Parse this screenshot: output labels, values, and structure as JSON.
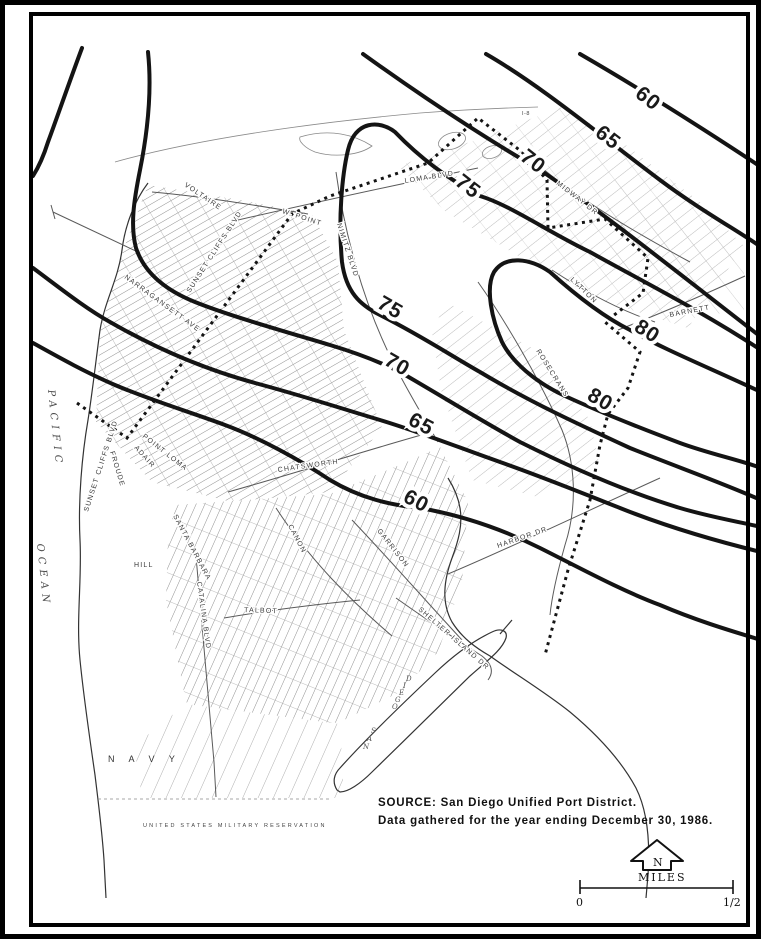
{
  "page": {
    "background": "#ffffff",
    "ink": "#141414",
    "street_gray": "#8f8f8f"
  },
  "source": {
    "line1": "SOURCE:  San Diego Unified Port District.",
    "line2": "Data gathered for the year ending December 30, 1986."
  },
  "scale": {
    "left": "0",
    "right": "1/2",
    "units": "MILES",
    "north_letter": "N"
  },
  "ocean": {
    "line1": "PACIFIC",
    "line2": "OCEAN"
  },
  "bay": {
    "word1_letters": [
      "S",
      "A",
      "N"
    ],
    "word2_letters": [
      "D",
      "I",
      "E",
      "G",
      "O"
    ]
  },
  "areas": {
    "navy": "N A V Y",
    "military": "UNITED STATES MILITARY RESERVATION"
  },
  "contour_labels": [
    {
      "text": "60"
    },
    {
      "text": "65"
    },
    {
      "text": "70"
    },
    {
      "text": "75"
    },
    {
      "text": "80"
    },
    {
      "text": "80"
    },
    {
      "text": "75"
    },
    {
      "text": "70"
    },
    {
      "text": "65"
    },
    {
      "text": "60"
    }
  ],
  "street_labels": [
    {
      "text": "VOLTAIRE"
    },
    {
      "text": "SUNSET CLIFFS BLVD"
    },
    {
      "text": "NARRAGANSETT AVE"
    },
    {
      "text": "W. POINT"
    },
    {
      "text": "LOMA BLVD"
    },
    {
      "text": "NIMITZ BLVD"
    },
    {
      "text": "MIDWAY DR"
    },
    {
      "text": "LYTTON"
    },
    {
      "text": "BARNETT"
    },
    {
      "text": "ROSECRANS"
    },
    {
      "text": "SUNSET CLIFFS BLVD"
    },
    {
      "text": "FROUDE"
    },
    {
      "text": "POINT LOMA"
    },
    {
      "text": "ADAIR"
    },
    {
      "text": "CHATSWORTH"
    },
    {
      "text": "CANON"
    },
    {
      "text": "SANTA BARBARA"
    },
    {
      "text": "HILL"
    },
    {
      "text": "CATALINA BLVD"
    },
    {
      "text": "TALBOT"
    },
    {
      "text": "GARRISON"
    },
    {
      "text": "HARBOR DR"
    },
    {
      "text": "SHELTER ISLAND DR"
    },
    {
      "text": "I-8"
    }
  ]
}
